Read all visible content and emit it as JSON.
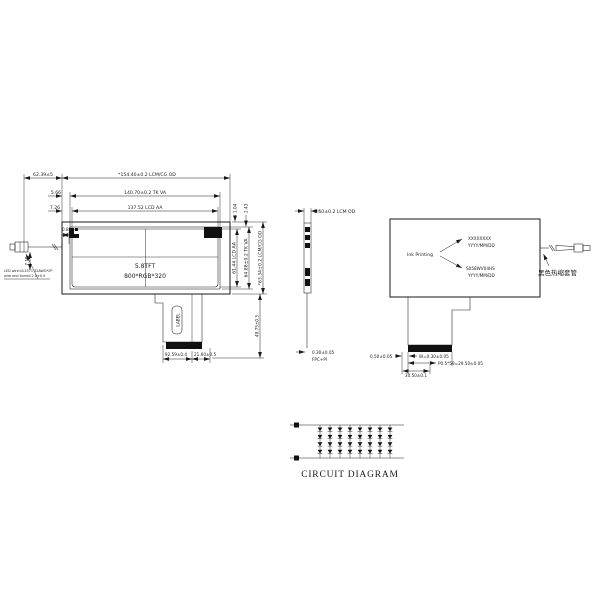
{
  "front": {
    "wire_len": "62.39±5",
    "od_width": "*154.40±0.2  LCM/CG OD",
    "va_gap": "5.66",
    "va_width": "140.70±0.2 TK  VA",
    "aa_gap": "7.26",
    "aa_width": "137.52 LCD AA",
    "gap_top1": "1.04",
    "gap_top2": "2.43",
    "aa_height": "61.44 LCD AA",
    "va_height": "64.88±0.2 TK  VA",
    "od_height": "*63.34±0.2 LCM/CG OD",
    "wire_stub": "0.80",
    "wire_drop": "7.19",
    "screen1": "5.8TFT",
    "screen2": "800*RGB*320",
    "label": "LABEL",
    "note1": "LED wire:UL1571 32AWG*2P",
    "note2": "wire end tinned 2.0±0.5",
    "fpc_x": "92.59±0.4",
    "fpc_w": "21.60±0.5",
    "fpc_len": "49.75±0.5"
  },
  "side": {
    "od": "5.50±0.2 LCM OD",
    "fpc": "0.30±0.05",
    "fpc2": "FPC+PI"
  },
  "back": {
    "ink": "Ink Printing",
    "m1a": "XXXXXXXX",
    "m1b": "YYYY/MM/DD",
    "m2a": "S058WV04HS",
    "m2b": "YYYY/MM/DD",
    "shrink": "黑色热缩套管",
    "gap": "0.50±0.05",
    "w": "W=0.30±0.05",
    "pitch": "P0.5*59=29.50±0.05",
    "cw": "30.50±0.1"
  },
  "circuit": {
    "title": "CIRCUIT DIAGRAM",
    "columns": 8,
    "rows": 4,
    "col_start_x": 320,
    "col_spacing": 10,
    "rail_top_y": 425,
    "rail_bot_y": 458
  }
}
